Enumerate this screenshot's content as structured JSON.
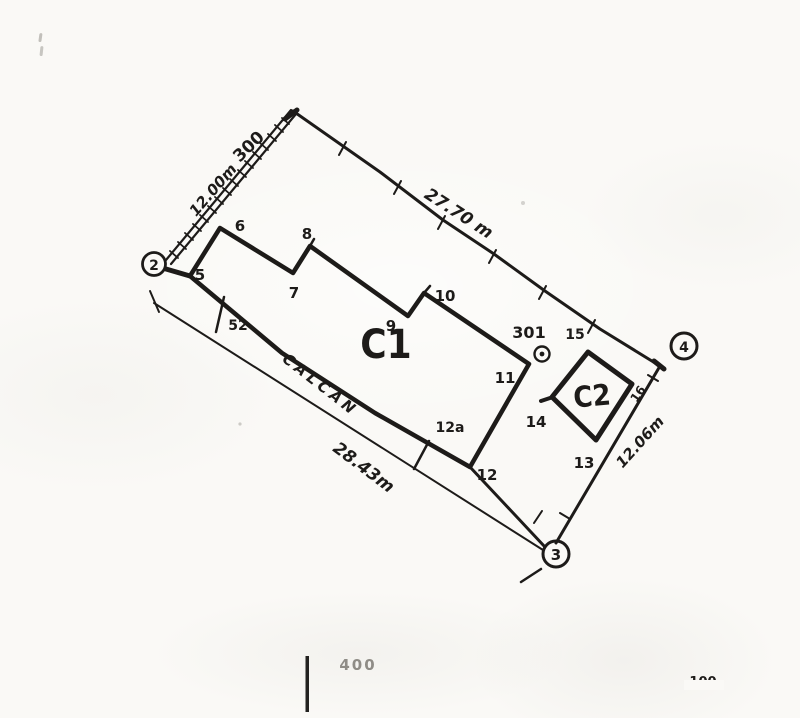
{
  "plan": {
    "buildings": {
      "c1": "C1",
      "c2": "C2"
    },
    "wall_label": "CALCAN",
    "dimensions": {
      "left_side": "12.00m",
      "top_side": "27.70 m",
      "bottom_side": "28.43m",
      "right_side": "12.06m"
    },
    "stations": {
      "s2": "2",
      "s3": "3",
      "s4": "4"
    },
    "points": {
      "p5": "5",
      "p6": "6",
      "p7": "7",
      "p8": "8",
      "p9": "9",
      "p10": "10",
      "p11": "11",
      "p12": "12",
      "p12a": "12a",
      "p13": "13",
      "p14": "14",
      "p15": "15",
      "p16": "16",
      "p52": "52",
      "p300": "300",
      "p301": "301"
    },
    "margin_marks": {
      "bottom_left_number": "400",
      "bottom_right_number": "100"
    },
    "colors": {
      "ink": "#1d1b19",
      "paper": "#faf9f6",
      "faint_ink": "#7d7a74"
    }
  }
}
